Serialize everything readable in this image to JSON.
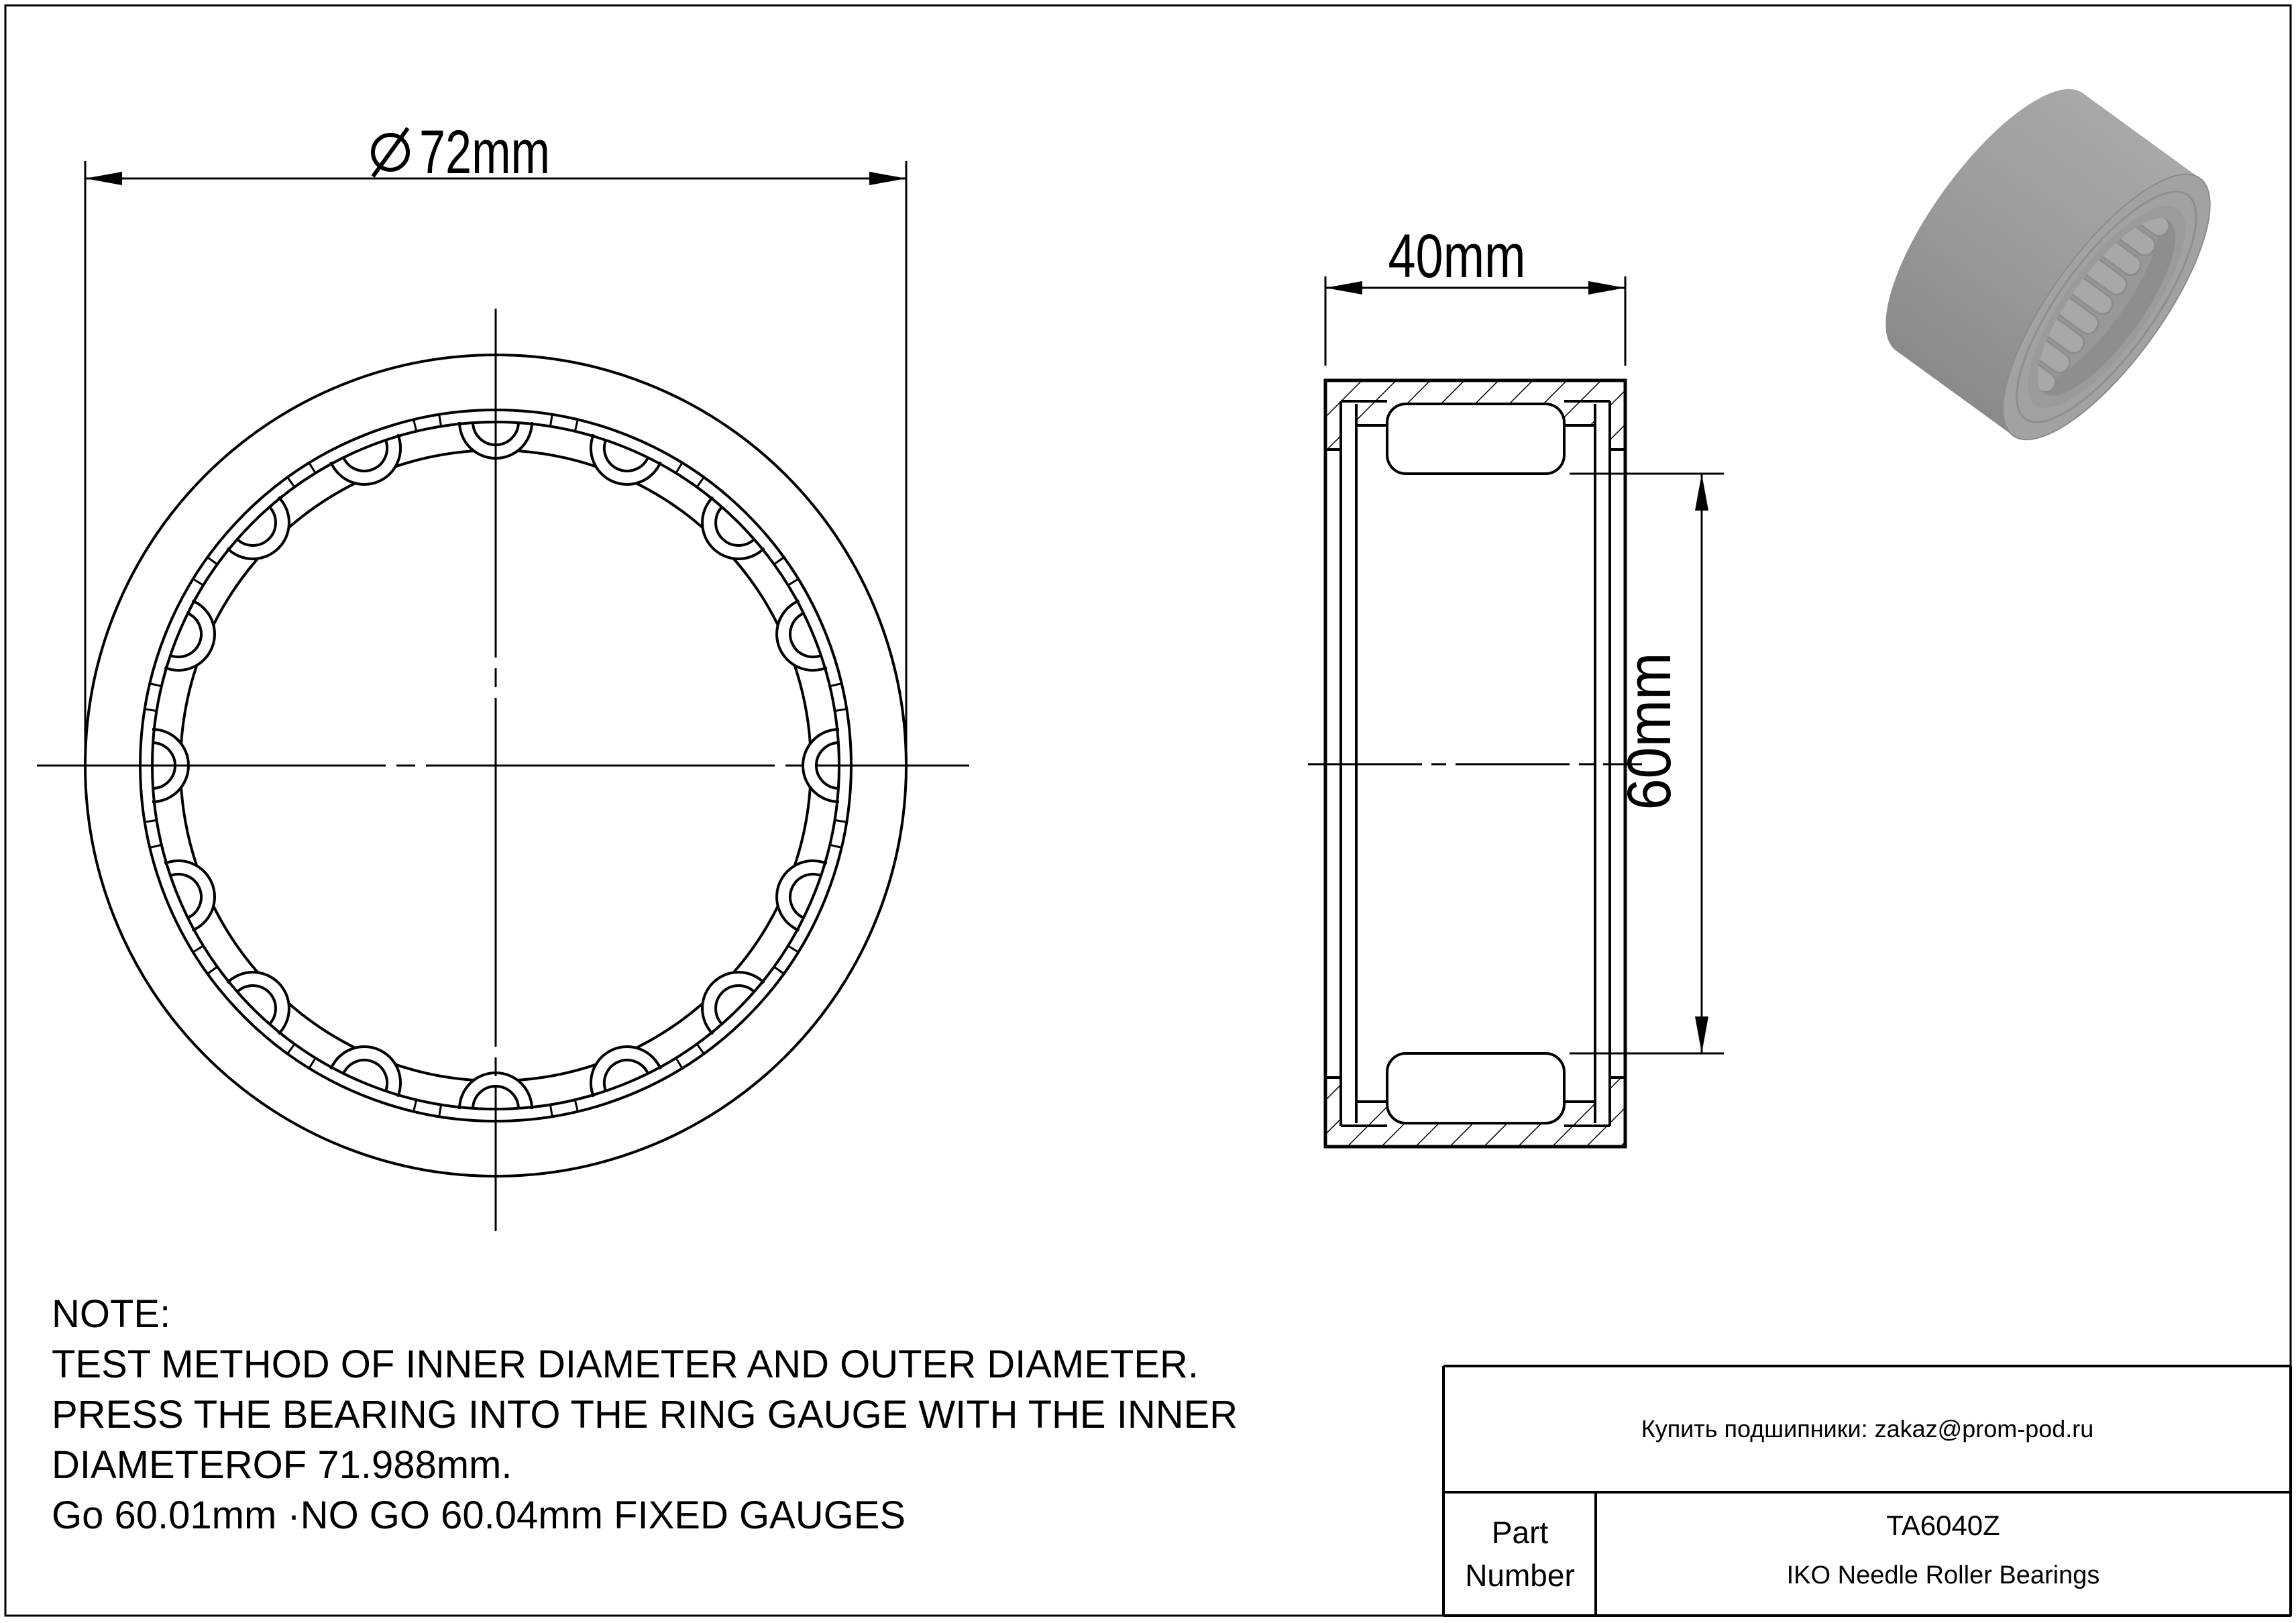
{
  "sheet": {
    "background": "#ffffff",
    "line_color": "#000000"
  },
  "front_view": {
    "diameter_label": "72mm",
    "roller_count": 16
  },
  "section_view": {
    "width_label": "40mm",
    "bore_label": "60mm"
  },
  "render_3d": {
    "body_color": "#9b9b9b",
    "body_dark": "#8a8a8a",
    "body_light": "#a8a8a8",
    "face_color": "#a2a2a2",
    "lip_color": "#9b9b9b",
    "groove_color": "#8f8f8f",
    "bore_color": "#8e8e8e",
    "far_wall_color": "#989898",
    "roller_color": "#a8a8a8",
    "roller_edge": "#8d8d8d"
  },
  "note": {
    "title": "NOTE:",
    "lines": [
      "TEST METHOD OF INNER DIAMETER AND OUTER DIAMETER.",
      "PRESS THE BEARING INTO THE RING GAUGE WITH THE INNER",
      "DIAMETEROF 71.988mm.",
      "Go 60.01mm ·NO GO 60.04mm FIXED GAUGES"
    ]
  },
  "title_block": {
    "contact": "Купить подшипники: zakaz@prom-pod.ru",
    "part_label_line1": "Part",
    "part_label_line2": "Number",
    "part_number": "TA6040Z",
    "product_line": "IKO Needle Roller Bearings"
  }
}
